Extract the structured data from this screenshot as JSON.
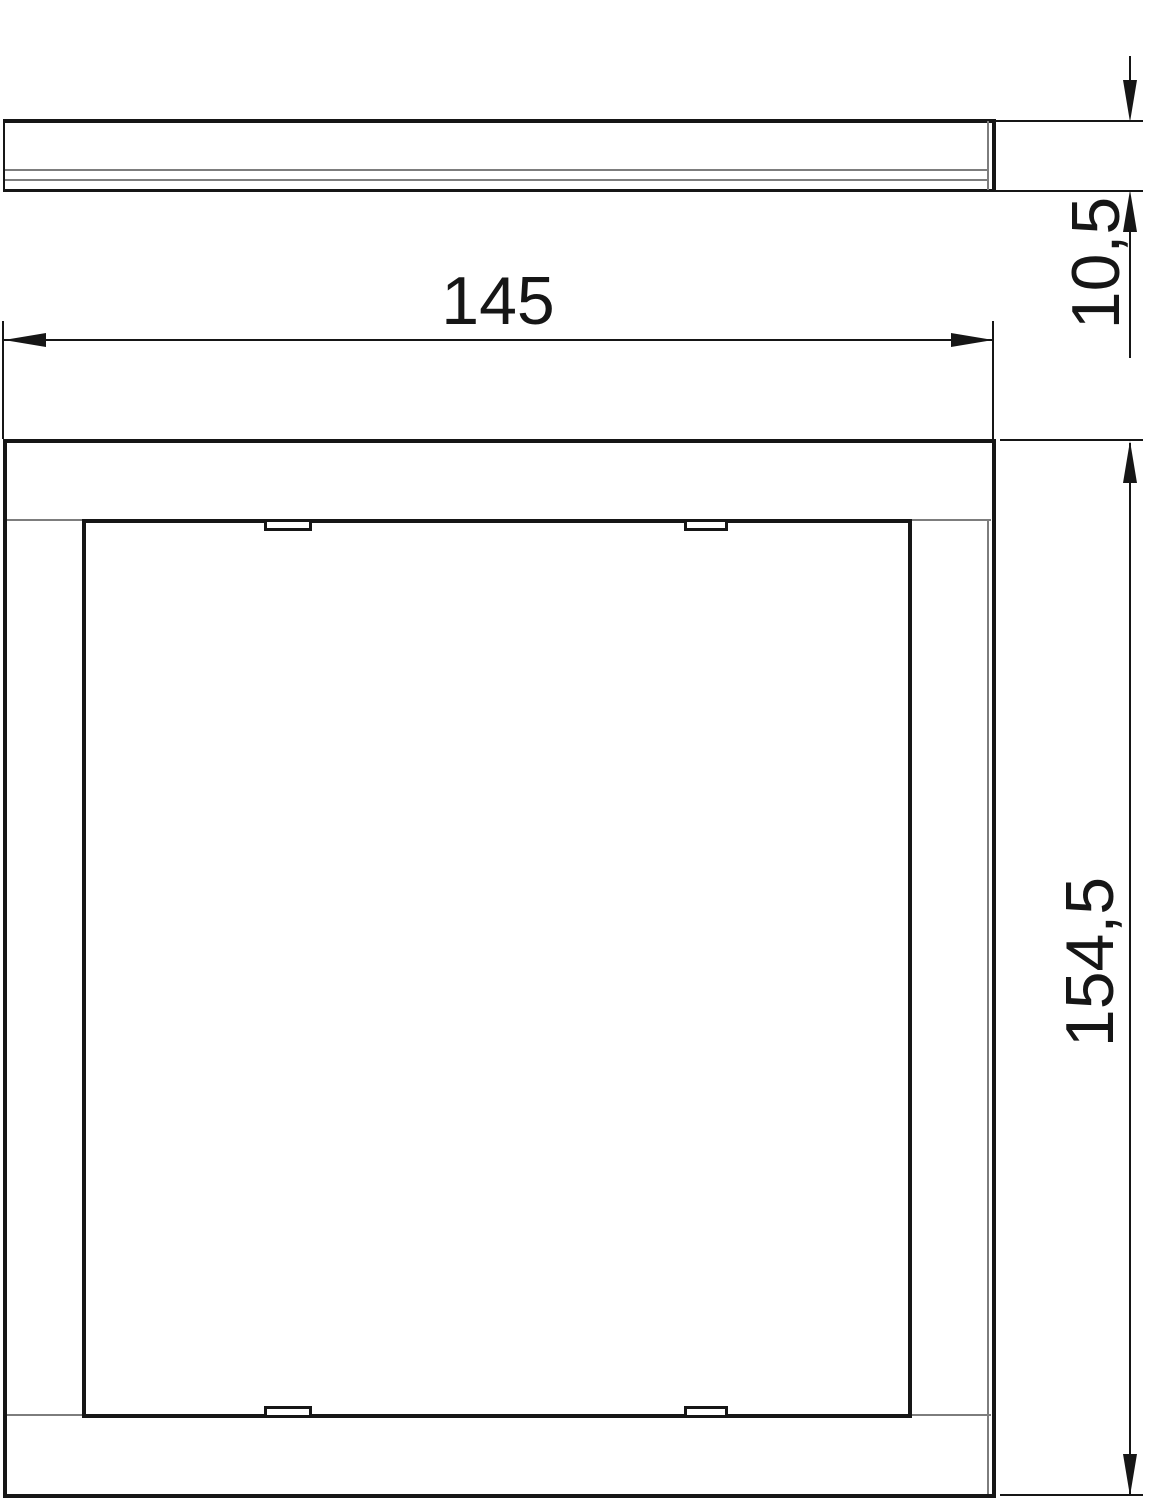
{
  "drawing": {
    "type": "technical-drawing",
    "views": {
      "side_view": "profile side view of cover frame",
      "front_view": "top view of cover frame with cover plate and clip notches"
    },
    "dimension_labels": {
      "width": "145",
      "thickness": "10,5",
      "height": "154,5"
    },
    "colors": {
      "line": "#161616",
      "thin_line": "#7d7d7d",
      "background": "#ffffff"
    }
  }
}
